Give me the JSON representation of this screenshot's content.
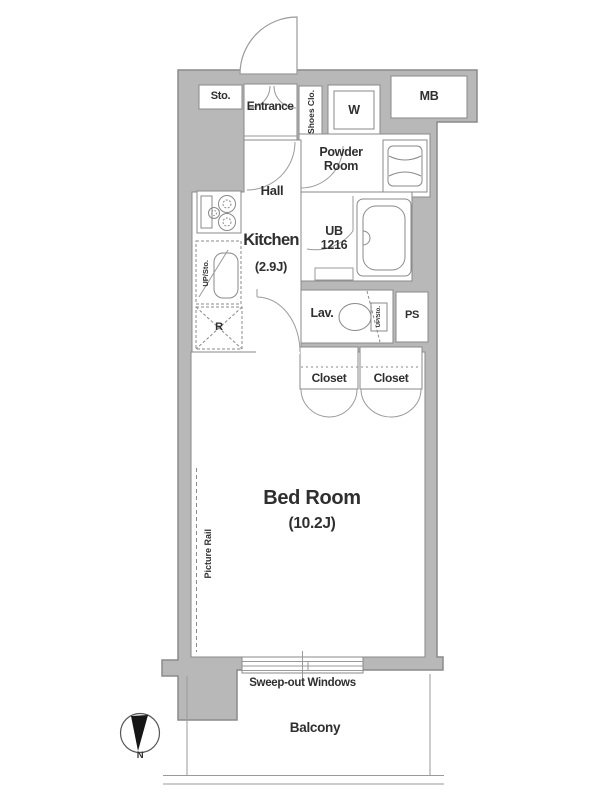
{
  "title": "Apartment floor plan",
  "colors": {
    "wall_fill": "#b8b8b8",
    "wall_outline": "#8a8a8a",
    "fixture_line": "#9a9a9a",
    "text": "#2f2f2f",
    "compass_needle": "#161616"
  },
  "labels": {
    "sto": "Sto.",
    "entrance": "Entrance",
    "shoes_closet": "Shoes Clo.",
    "washing_machine": "W",
    "meter_box": "MB",
    "powder_room": "Powder Room",
    "hall": "Hall",
    "kitchen": "Kitchen",
    "kitchen_size": "(2.9J)",
    "unit_bath": "UB",
    "unit_bath_size": "1216",
    "lavatory": "Lav.",
    "pipe_space": "PS",
    "upper_storage_kitchen": "UP/Sto.",
    "upper_storage_toilet": "UP/Sto.",
    "refrigerator": "R",
    "closet_left": "Closet",
    "closet_right": "Closet",
    "bed_room": "Bed Room",
    "bed_room_size": "(10.2J)",
    "picture_rail": "Picture Rail",
    "sweep_out_windows": "Sweep-out Windows",
    "balcony": "Balcony",
    "compass_north": "N"
  }
}
